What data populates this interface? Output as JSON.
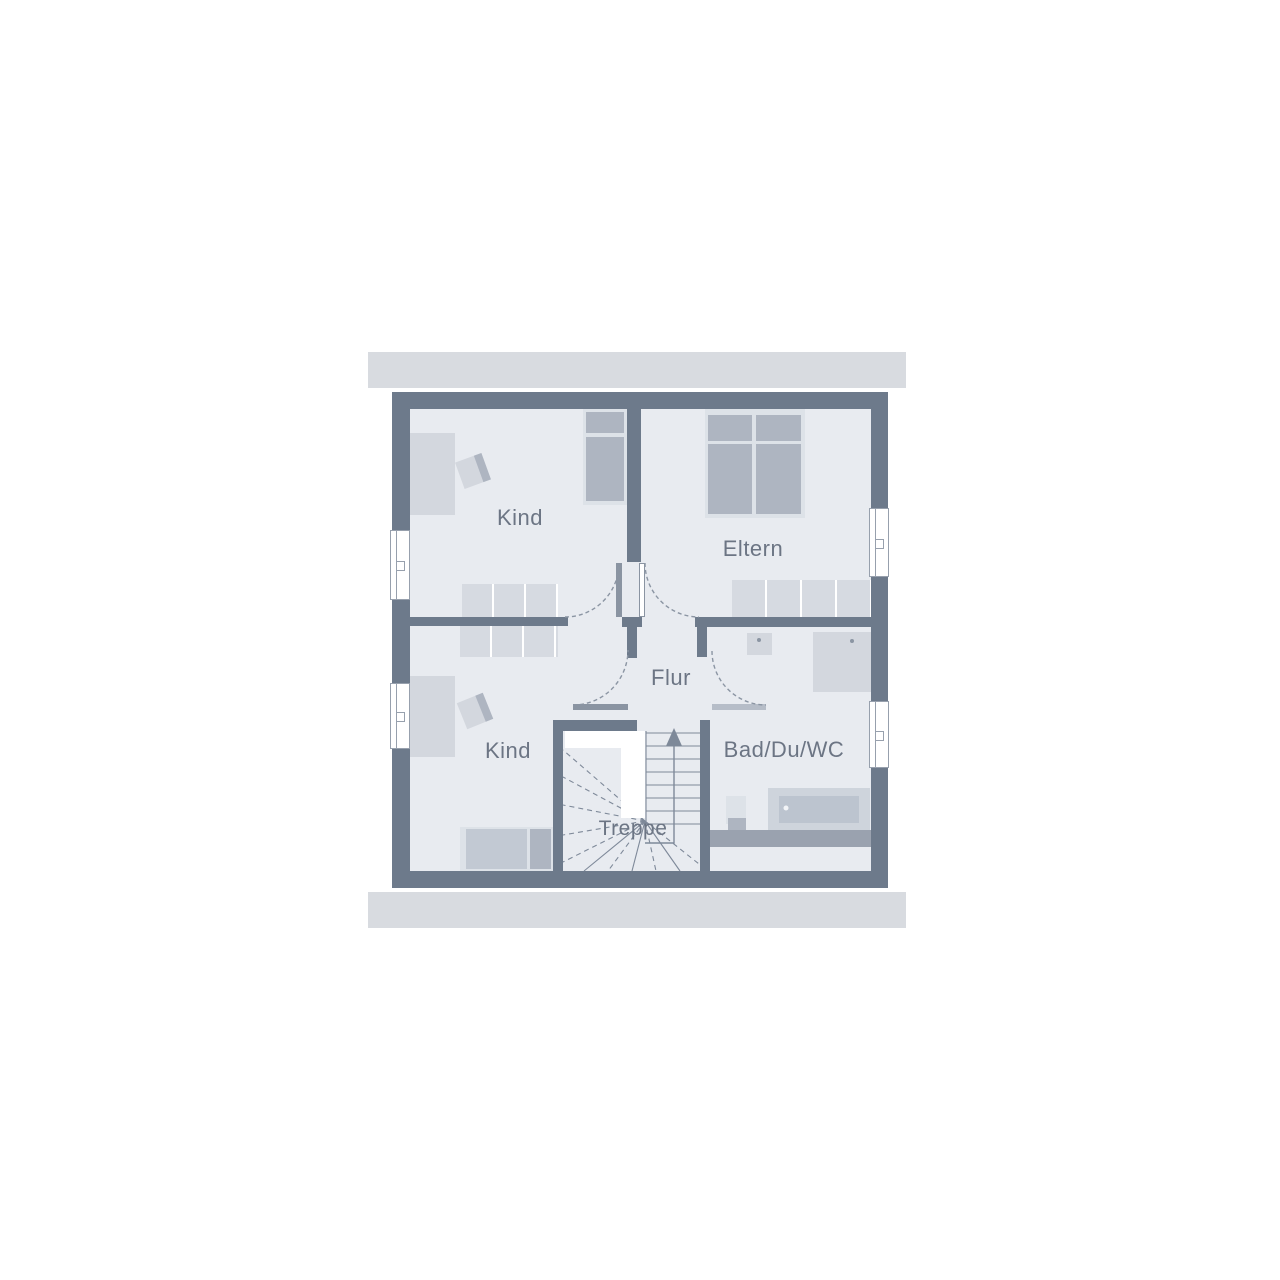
{
  "floorplan": {
    "type": "floor-plan-upper-storey",
    "rooms": [
      {
        "id": "kind_top",
        "label": "Kind"
      },
      {
        "id": "eltern",
        "label": "Eltern"
      },
      {
        "id": "kind_bottom",
        "label": "Kind"
      },
      {
        "id": "flur",
        "label": "Flur"
      },
      {
        "id": "bad",
        "label": "Bad/Du/WC"
      },
      {
        "id": "treppe",
        "label": "Treppe"
      }
    ],
    "symbols": [
      {
        "name": "stairs-up-arrow",
        "meaning": "stair direction up"
      },
      {
        "name": "door-arc",
        "meaning": "door swing (dashed quarter circle)"
      },
      {
        "name": "window",
        "meaning": "window in exterior wall"
      }
    ],
    "colors": {
      "wall": "#6d7a8b",
      "floor": "#e8ebf0",
      "roof_band": "#d8dbe0",
      "knee_wall": "#9aa2af",
      "furniture_light": "#dde2e8",
      "furniture_mid": "#c2c9d3",
      "bed_block": "#aeb5c1",
      "desk": "#d3d7de",
      "wardrobe": "#d6dae1",
      "linework": "#7e8999",
      "label_text": "#6c7584"
    }
  }
}
